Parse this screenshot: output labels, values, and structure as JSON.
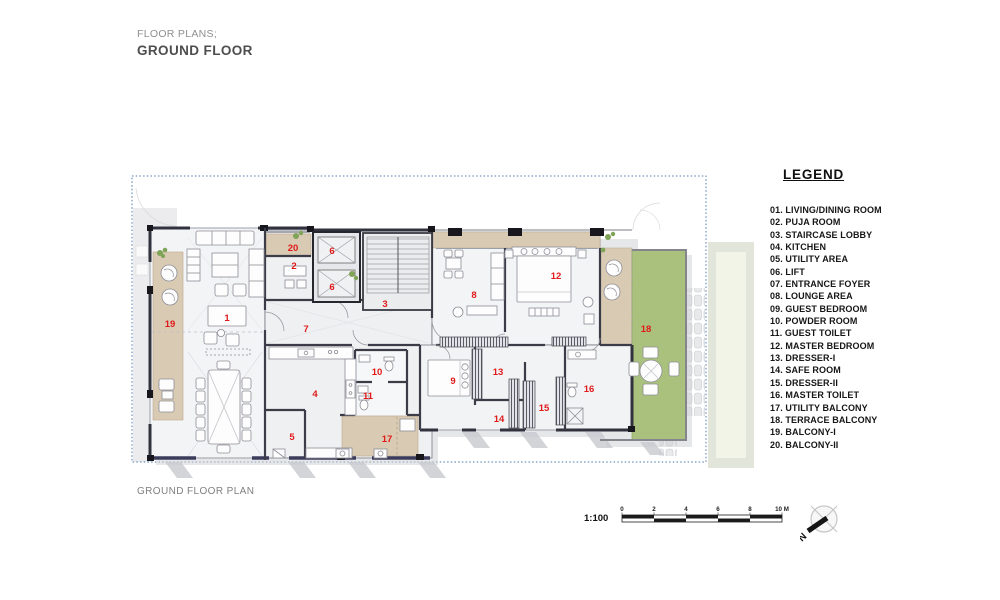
{
  "title": {
    "kicker": "FLOOR PLANS;",
    "name": "GROUND FLOOR"
  },
  "caption": "GROUND FLOOR PLAN",
  "legend": {
    "title": "LEGEND",
    "items": [
      "01. LIVING/DINING ROOM",
      "02. PUJA ROOM",
      "03. STAIRCASE LOBBY",
      "04. KITCHEN",
      "05. UTILITY AREA",
      "06. LIFT",
      "07. ENTRANCE FOYER",
      "08. LOUNGE AREA",
      "09. GUEST BEDROOM",
      "10. POWDER ROOM",
      "11. GUEST TOILET",
      "12. MASTER BEDROOM",
      "13. DRESSER-I",
      "14. SAFE ROOM",
      "15. DRESSER-II",
      "16. MASTER TOILET",
      "17. UTILITY BALCONY",
      "18. TERRACE BALCONY",
      "19. BALCONY-I",
      "20. BALCONY-II"
    ]
  },
  "scale": {
    "ratio": "1:100",
    "ticks": [
      "0",
      "2",
      "4",
      "6",
      "8",
      "10 M"
    ]
  },
  "north": {
    "label": "N"
  },
  "plan": {
    "numbers": [
      {
        "n": "1",
        "x": 227,
        "y": 321
      },
      {
        "n": "2",
        "x": 294,
        "y": 269
      },
      {
        "n": "3",
        "x": 385,
        "y": 307
      },
      {
        "n": "4",
        "x": 315,
        "y": 397
      },
      {
        "n": "5",
        "x": 292,
        "y": 440
      },
      {
        "n": "6",
        "x": 332,
        "y": 254
      },
      {
        "n": "6",
        "x": 332,
        "y": 290
      },
      {
        "n": "7",
        "x": 306,
        "y": 332
      },
      {
        "n": "8",
        "x": 474,
        "y": 298
      },
      {
        "n": "9",
        "x": 453,
        "y": 384
      },
      {
        "n": "10",
        "x": 377,
        "y": 375
      },
      {
        "n": "11",
        "x": 368,
        "y": 399
      },
      {
        "n": "12",
        "x": 556,
        "y": 279
      },
      {
        "n": "13",
        "x": 498,
        "y": 375
      },
      {
        "n": "14",
        "x": 499,
        "y": 422
      },
      {
        "n": "15",
        "x": 544,
        "y": 411
      },
      {
        "n": "16",
        "x": 589,
        "y": 392
      },
      {
        "n": "17",
        "x": 387,
        "y": 442
      },
      {
        "n": "18",
        "x": 646,
        "y": 332
      },
      {
        "n": "19",
        "x": 170,
        "y": 327
      },
      {
        "n": "20",
        "x": 293,
        "y": 251
      }
    ]
  },
  "colors": {
    "room_number_red": "#e01a1a",
    "balcony_tan": "#d9cab3",
    "lawn_green": "#a9c17c",
    "boundary_blue": "#4a79b0",
    "wall_dark": "#32323e"
  }
}
